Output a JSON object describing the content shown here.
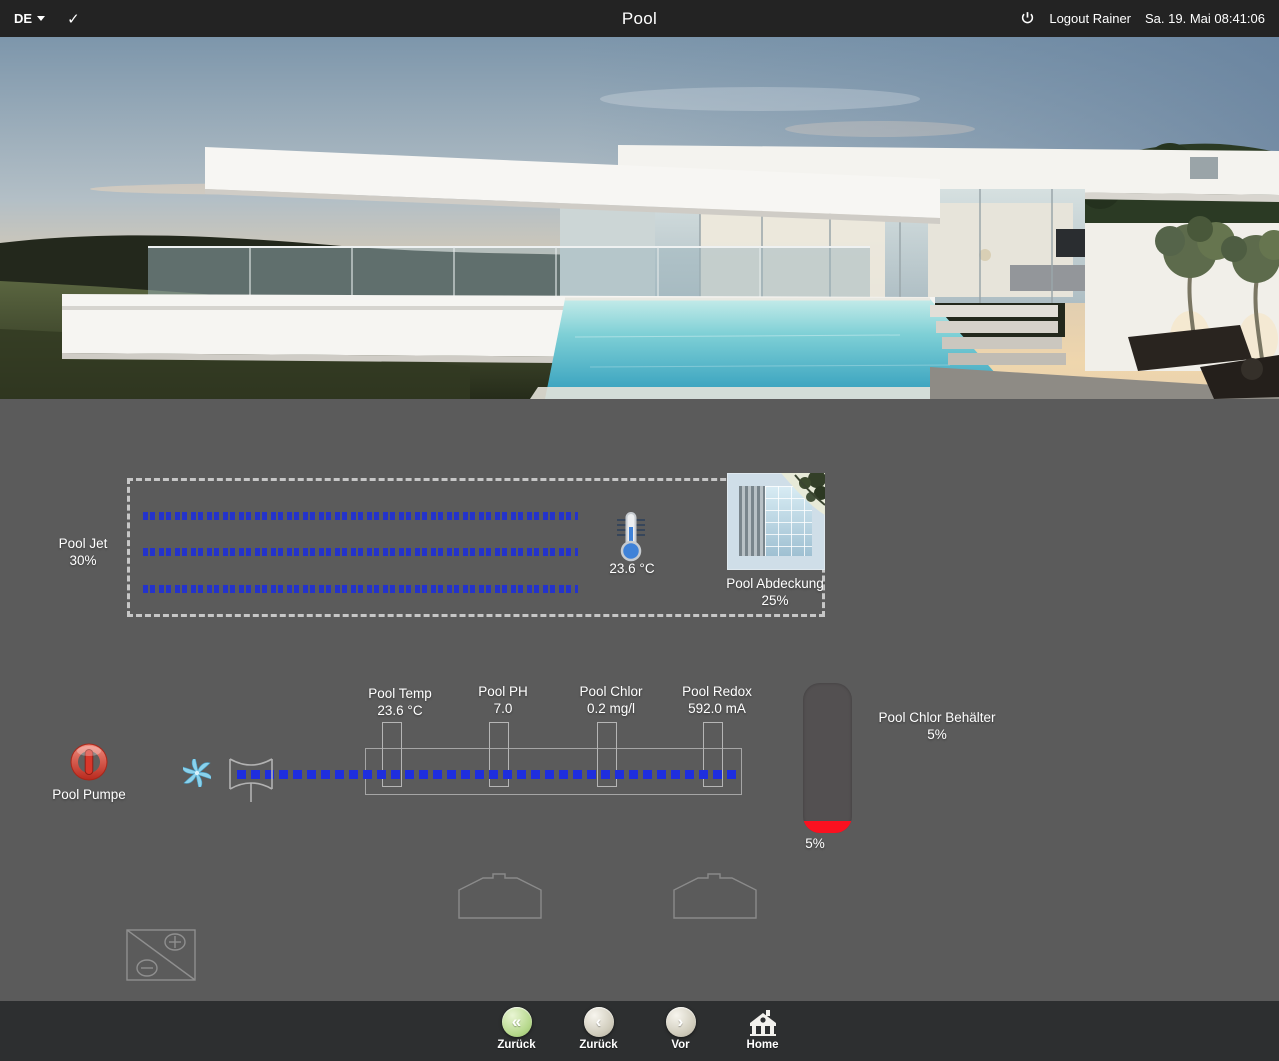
{
  "topbar": {
    "language": "DE",
    "check_glyph": "✓",
    "title": "Pool",
    "logout_label": "Logout Rainer",
    "datetime": "Sa. 19. Mai 08:41:06"
  },
  "jet": {
    "label": "Pool Jet",
    "value": "30%"
  },
  "temperature": {
    "value": "23.6 °C"
  },
  "cover": {
    "label": "Pool Abdeckung",
    "value": "25%"
  },
  "sensors": [
    {
      "label": "Pool Temp",
      "value": "23.6 °C"
    },
    {
      "label": "Pool PH",
      "value": "7.0"
    },
    {
      "label": "Pool Chlor",
      "value": "0.2 mg/l"
    },
    {
      "label": "Pool Redox",
      "value": "592.0 mA"
    }
  ],
  "pump": {
    "label": "Pool Pumpe"
  },
  "tank": {
    "label": "Pool Chlor Behälter",
    "value": "5%",
    "level_label": "5%",
    "level_percent": 5
  },
  "nav": {
    "items": [
      {
        "label": "Zurück",
        "icon": "double-chevron-left",
        "glyph": "«"
      },
      {
        "label": "Zurück",
        "icon": "chevron-left",
        "glyph": "‹"
      },
      {
        "label": "Vor",
        "icon": "chevron-right",
        "glyph": "›"
      },
      {
        "label": "Home",
        "icon": "home"
      }
    ]
  },
  "colors": {
    "background": "#5b5b5b",
    "topbar": "#232323",
    "bottombar": "#2d2f30",
    "pipe_blue": "#1e2ede",
    "tank_red": "#fb1120",
    "nav_green": "#b6d88c"
  }
}
